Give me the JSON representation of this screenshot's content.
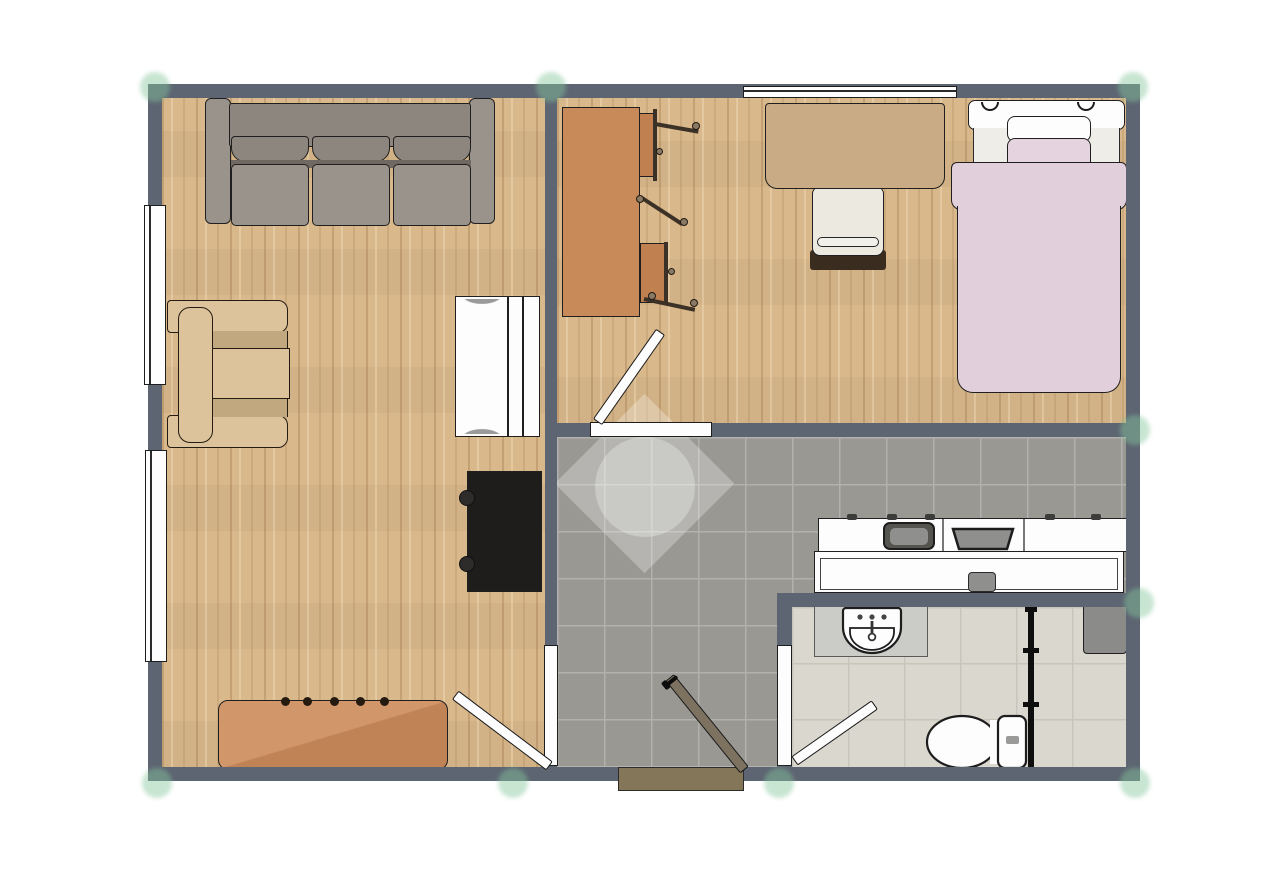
{
  "document": {
    "title": "apartment-floor-plan",
    "kind": "2d-top-down-floor-plan",
    "text_labels": []
  },
  "palette": {
    "wall": "#5d6572",
    "wood": "#d9b88b",
    "kitchen_tile": "#999893",
    "kitchen_grout": "#b2b1ad",
    "bath_tile": "#dad7cf",
    "bath_grout": "#c8c5bc",
    "frame_white": "#fdfdfd",
    "door_wood": "#7d7260",
    "threshold": "#847659",
    "sofa": "#9a938b",
    "sofa_back": "#8d867e",
    "sofa_shadow": "#6f6861",
    "armchair": "#ddc39c",
    "armchair_shadow": "#c2a87e",
    "desk_brown": "#c88a59",
    "desk_tan": "#c9ab85",
    "chair_seat_brown": "#c08050",
    "table_brown": "#c08355",
    "table_brown_light": "#d2966b",
    "bed_pink": "#e2cfdc",
    "bed_mattress": "#efede8",
    "tv_black": "#1f1d1c",
    "fixture_gray": "#8f8f8d",
    "fixture_gray_dark": "#55544f",
    "vanity_gray": "#cbcbc8",
    "node_green": "rgba(134,197,156,0.45)",
    "watermark_white": "rgba(255,255,255,0.28)"
  },
  "rooms": [
    {
      "id": "living-room",
      "floor": "wood",
      "furniture": [
        "three-seat-sofa",
        "armchair",
        "white-cabinet",
        "tv",
        "sideboard-table"
      ],
      "windows": 2,
      "doors": [
        "door-to-kitchen"
      ]
    },
    {
      "id": "bedroom",
      "floor": "wood",
      "furniture": [
        "work-table",
        "folding-chair",
        "folding-chair",
        "desk",
        "desk-chair",
        "single-bed"
      ],
      "windows": 1,
      "doors": [
        "door-to-kitchen"
      ]
    },
    {
      "id": "kitchen-hall",
      "floor": "dark-gray-tile",
      "furniture": [
        "kitchen-counter",
        "kitchen-sink",
        "cooktop",
        "kitchen-table",
        "stool"
      ],
      "windows": 0,
      "doors": [
        "entrance-door",
        "door-to-living-room",
        "door-to-bedroom",
        "door-to-bathroom"
      ]
    },
    {
      "id": "bathroom",
      "floor": "light-tile",
      "furniture": [
        "vanity-sink",
        "toilet",
        "shower-screen",
        "cabinet-box"
      ],
      "windows": 0,
      "doors": [
        "door-to-kitchen"
      ]
    }
  ],
  "watermark": {
    "shape": "diamond-and-circle",
    "position": "center-of-plan"
  },
  "editor_nodes": {
    "count": 9,
    "style": "translucent-green-dots-at-wall-junctions"
  }
}
